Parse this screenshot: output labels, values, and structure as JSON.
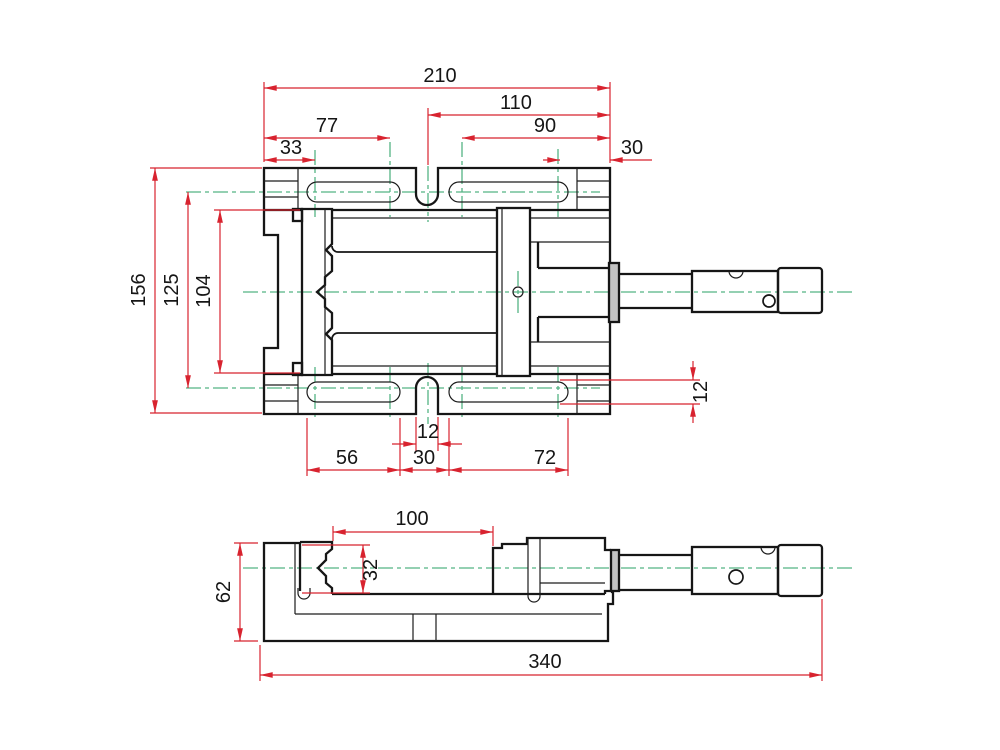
{
  "drawing": {
    "title": "machine-vise two-view technical drawing",
    "colors": {
      "outline": "#161616",
      "dimension": "#d8232f",
      "centerline": "#55b384",
      "background": "#ffffff",
      "collar_fill": "#c3c3c3"
    },
    "dims": {
      "overall_width": "210",
      "screw_side_span": "110",
      "slot1_center_span": "77",
      "slot1_center_offset": "33",
      "slot2_center_span": "90",
      "edge_offset": "30",
      "overall_depth": "156",
      "slot_centerline_distance": "125",
      "inner_depth": "104",
      "notch_width": "12",
      "slot1_length": "56",
      "slot_gap": "30",
      "slot2_length": "72",
      "slot_width": "12",
      "jaw_opening": "100",
      "jaw_depth": "32",
      "base_height": "62",
      "overall_length": "340"
    }
  }
}
